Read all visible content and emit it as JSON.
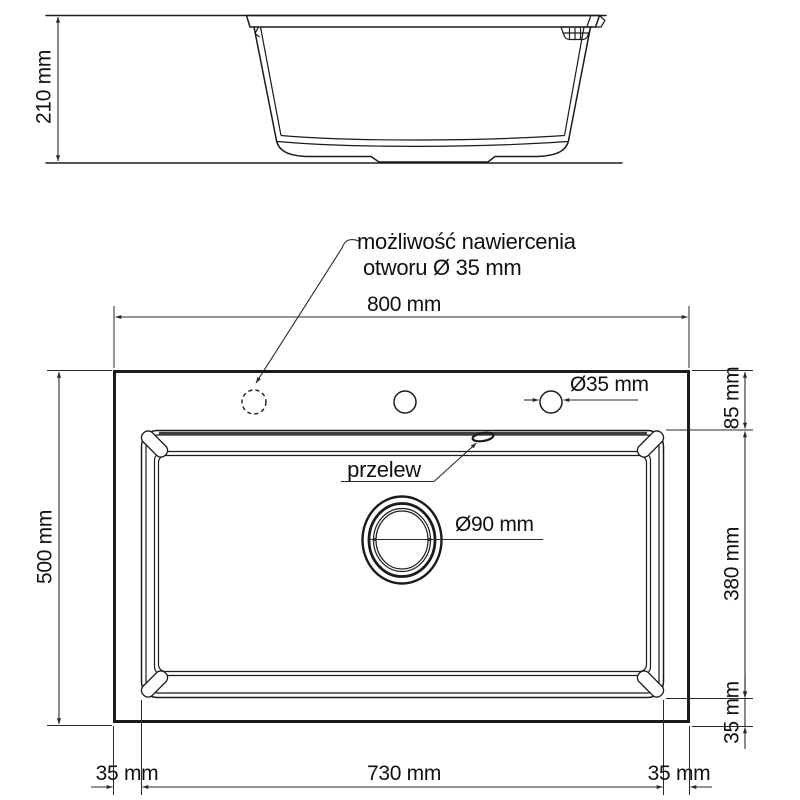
{
  "drawing": {
    "type": "technical-dimension-drawing",
    "views": {
      "side_view": {
        "height_label": "210 mm"
      },
      "plan_view": {
        "overall_width_label": "800 mm",
        "overall_depth_label": "500 mm",
        "faucet_hole_label": "Ø35 mm",
        "rim_to_bowl_label": "85 mm",
        "bowl_depth_label": "380 mm",
        "bowl_to_edge_label": "35 mm",
        "bottom_left_margin_label": "35 mm",
        "bowl_width_label": "730 mm",
        "bottom_right_margin_label": "35 mm",
        "drain_label": "Ø90 mm",
        "overflow_label": "przelew"
      }
    },
    "note": {
      "line1": "możliwość nawiercenia",
      "line2": "otworu Ø 35 mm"
    },
    "colors": {
      "line": "#1b1b1b",
      "dimension": "#2a2a2a",
      "background": "#ffffff"
    }
  }
}
